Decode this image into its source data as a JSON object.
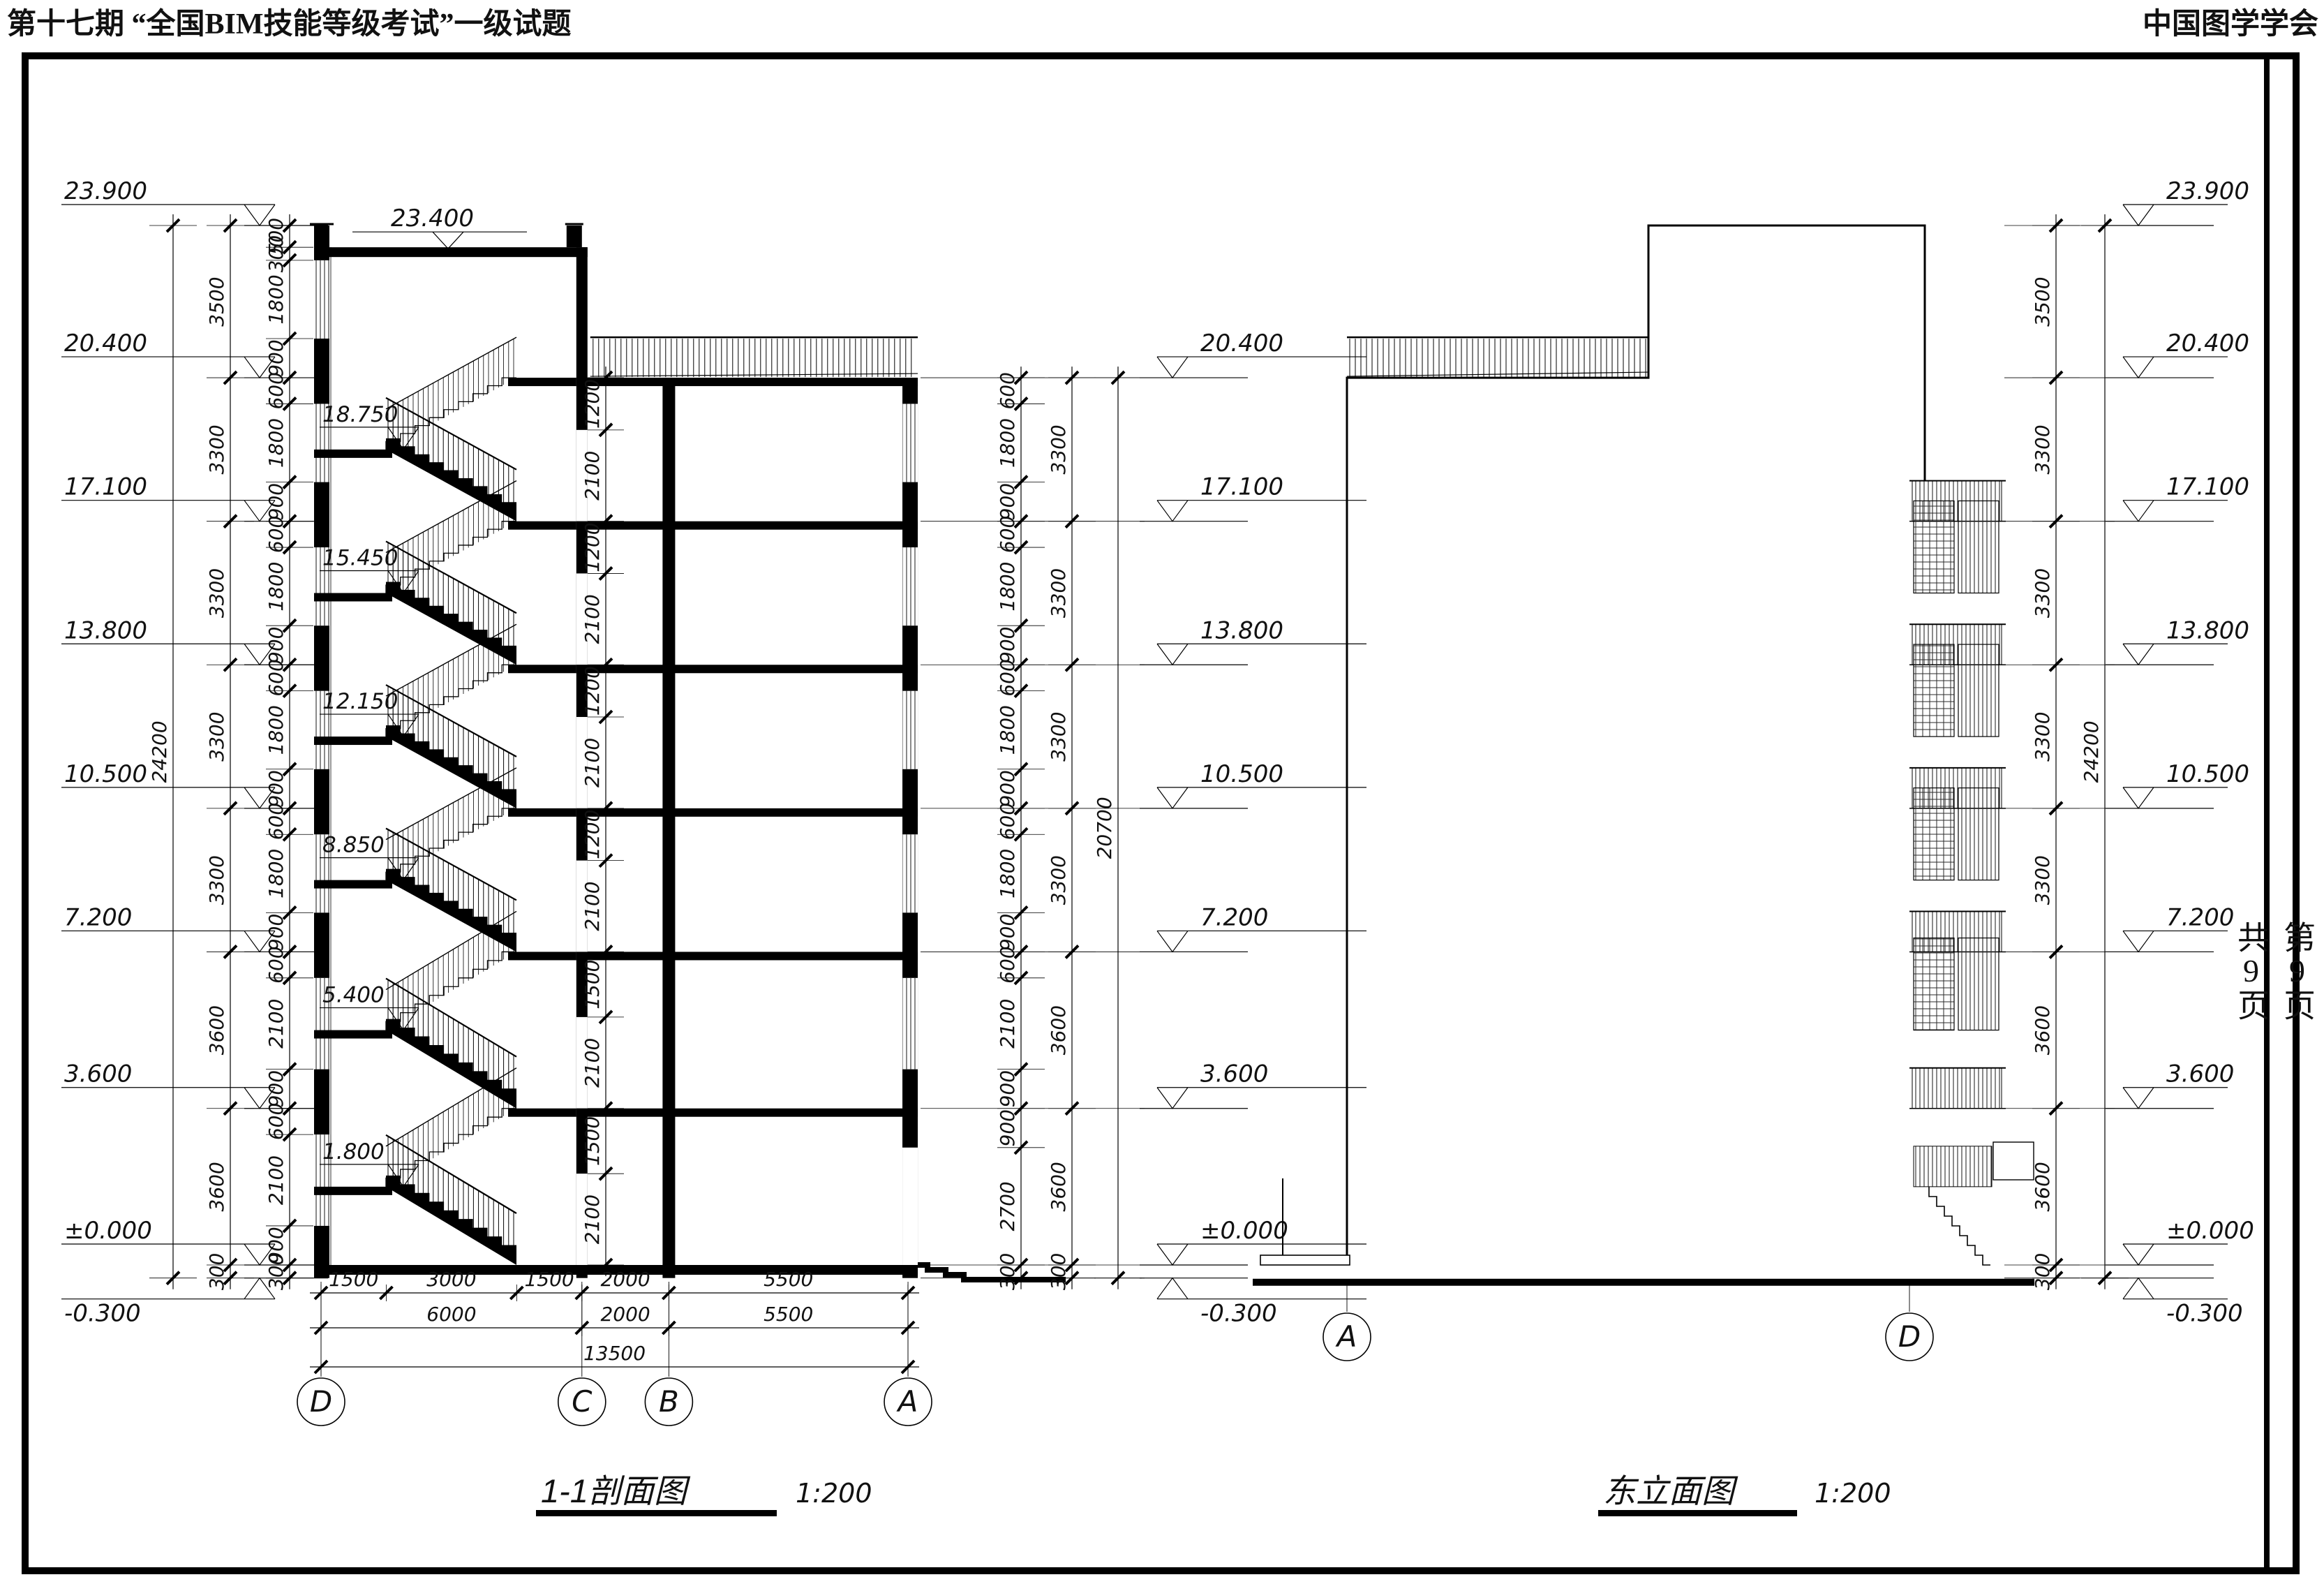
{
  "colors": {
    "ink": "#000000",
    "paper": "#ffffff"
  },
  "header": {
    "title": "第十七期 “全国BIM技能等级考试”一级试题",
    "org": "中国图学学会"
  },
  "page_panel": {
    "current": "第9页",
    "total": "共9页"
  },
  "section": {
    "name": "1-1剖面图",
    "scale": "1:200",
    "grids": [
      "D",
      "C",
      "B",
      "A"
    ],
    "levels_left": [
      "23.900",
      "20.400",
      "17.100",
      "13.800",
      "10.500",
      "7.200",
      "3.600",
      "±0.000",
      "-0.300"
    ],
    "levels_right": [
      "20.400",
      "17.100",
      "13.800",
      "10.500",
      "7.200",
      "3.600",
      "±0.000",
      "-0.300"
    ],
    "stair_levels": [
      "18.750",
      "15.450",
      "12.150",
      "8.850",
      "5.400",
      "1.800"
    ],
    "roof_level": "23.400",
    "dim_left_detail": [
      500,
      300,
      1800,
      900,
      600,
      1800,
      900,
      600,
      1800,
      900,
      600,
      1800,
      900,
      600,
      1800,
      900,
      600,
      2100,
      900,
      600,
      2100,
      900,
      300
    ],
    "dim_left_storey": [
      3500,
      3300,
      3300,
      3300,
      3300,
      3600,
      3600,
      300
    ],
    "dim_left_total": [
      24200
    ],
    "dim_right_detail": [
      600,
      1800,
      900,
      600,
      1800,
      900,
      600,
      1800,
      900,
      600,
      1800,
      900,
      600,
      2100,
      900,
      900,
      2700,
      300
    ],
    "dim_right_storey": [
      3300,
      3300,
      3300,
      3300,
      3600,
      3600,
      300
    ],
    "dim_right_total": [
      20700
    ],
    "dim_interior": [
      1200,
      2100,
      1200,
      2100,
      1200,
      2100,
      1200,
      2100,
      1500,
      2100,
      1500,
      2100
    ],
    "dim_bottom_row1": [
      1500,
      3000,
      1500,
      2000,
      5500
    ],
    "dim_bottom_row2": [
      6000,
      2000,
      5500
    ],
    "dim_bottom_row3": [
      13500
    ]
  },
  "east_elevation": {
    "name": "东立面图",
    "scale": "1:200",
    "grids": [
      "A",
      "D"
    ],
    "levels_right": [
      "23.900",
      "20.400",
      "17.100",
      "13.800",
      "10.500",
      "7.200",
      "3.600",
      "±0.000",
      "-0.300"
    ],
    "dim_right_storey": [
      3500,
      3300,
      3300,
      3300,
      3300,
      3600,
      3600,
      300
    ],
    "dim_right_total": [
      24200
    ]
  }
}
